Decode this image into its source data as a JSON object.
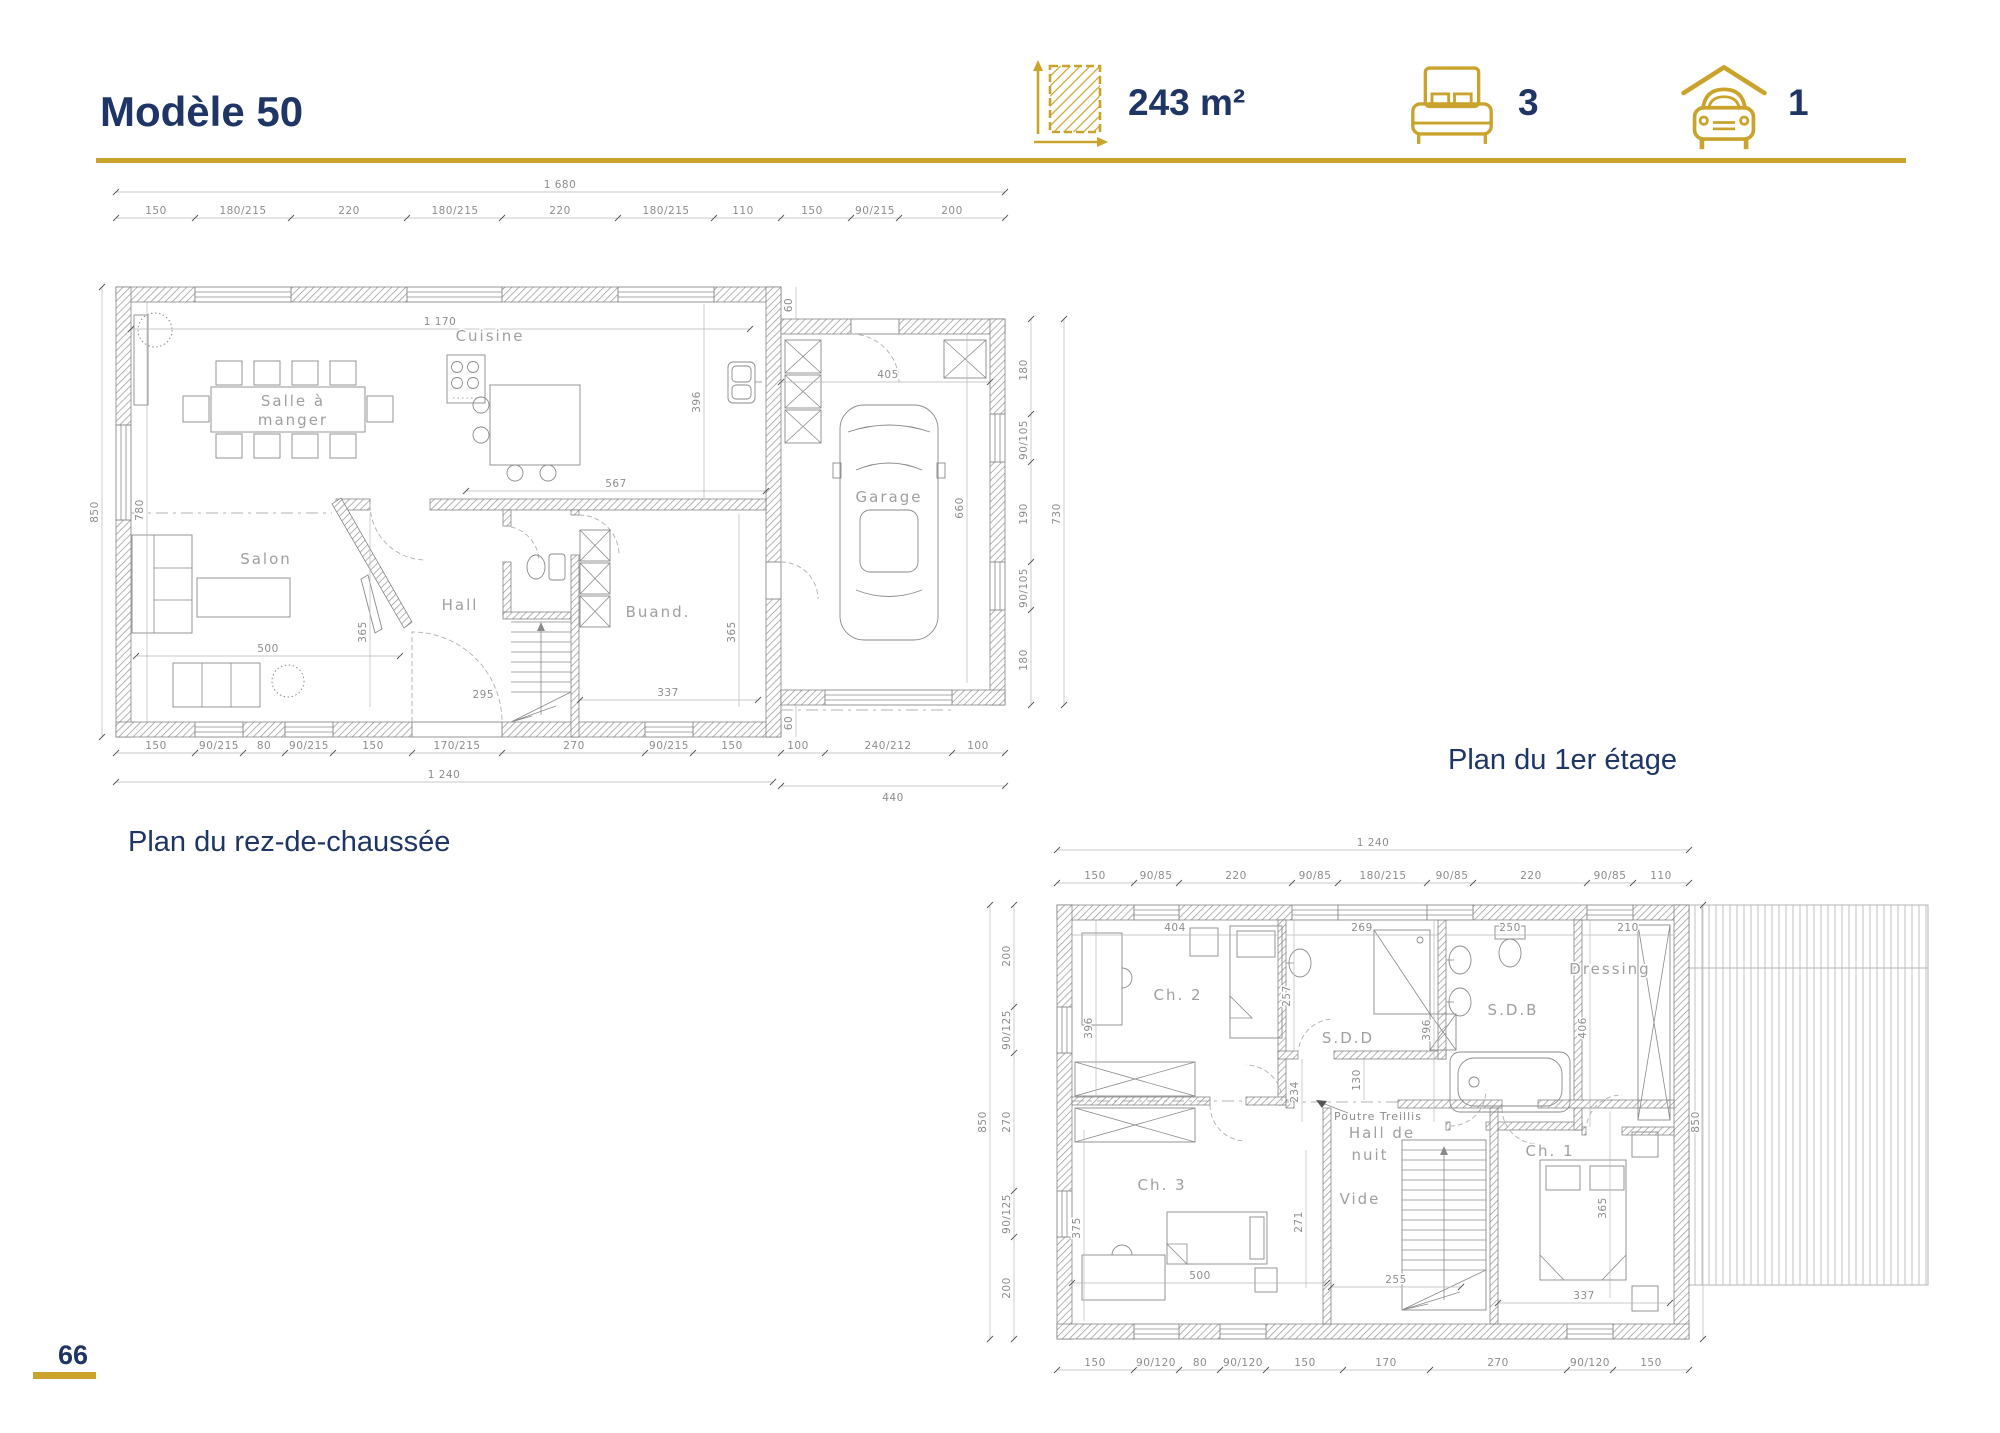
{
  "header": {
    "title": "Modèle 50",
    "area_value": "243 m²",
    "bedrooms_value": "3",
    "garage_value": "1"
  },
  "captions": {
    "ground": "Plan du rez-de-chaussée",
    "first": "Plan du 1er étage"
  },
  "footer": {
    "page_number": "66"
  },
  "ground": {
    "rooms": {
      "dining_1": "Salle à",
      "dining_2": "manger",
      "kitchen": "Cuisine",
      "living": "Salon",
      "hall": "Hall",
      "laundry": "Buand.",
      "garage": "Garage"
    },
    "dims": {
      "top_total": "1 680",
      "top_row": [
        "150",
        "180/215",
        "220",
        "180/215",
        "220",
        "180/215",
        "110",
        "150",
        "90/215",
        "200"
      ],
      "left_total": "850",
      "left_inner": "780",
      "inner_width": "1 170",
      "kitchen_depth": "396",
      "inner_567": "567",
      "hall_depth": "365",
      "stair_295": "295",
      "laundry_337": "337",
      "laundry_365": "365",
      "living_500": "500",
      "garage_405": "405",
      "garage_660": "660",
      "offset_top": "60",
      "offset_bottom": "60",
      "right_col": [
        "180",
        "90/105",
        "190",
        "90/105",
        "180"
      ],
      "right_total": "730",
      "bottom_row": [
        "150",
        "90/215",
        "80",
        "90/215",
        "150",
        "170/215",
        "270",
        "90/215",
        "150",
        "100",
        "240/212",
        "100"
      ],
      "bottom_main": "1 240",
      "bottom_garage": "440"
    }
  },
  "first": {
    "rooms": {
      "ch2": "Ch. 2",
      "sdd": "S.D.D",
      "sdb": "S.D.B",
      "dressing": "Dressing",
      "ch3": "Ch. 3",
      "hall_1": "Hall de",
      "hall_2": "nuit",
      "vide": "Vide",
      "ch1": "Ch. 1"
    },
    "annotation": "Poutre Treillis",
    "dims": {
      "top_total": "1 240",
      "top_row": [
        "150",
        "90/85",
        "220",
        "90/85",
        "180/215",
        "90/85",
        "220",
        "90/85",
        "110"
      ],
      "left_total": "850",
      "left_col": [
        "200",
        "90/125",
        "270",
        "90/125",
        "200"
      ],
      "right_total": "850",
      "bottom_row": [
        "150",
        "90/120",
        "80",
        "90/120",
        "150",
        "170",
        "270",
        "90/120",
        "150"
      ],
      "ch2_w": "404",
      "ch2_h": "396",
      "sdd_w": "269",
      "sdd_h": "257",
      "sdb_w": "250",
      "sdb_h": "396",
      "dress_w": "210",
      "dress_h": "406",
      "beam_130": "130",
      "beam_234": "234",
      "ch3_h": "375",
      "ch3_w": "500",
      "ch3_271": "271",
      "vide_255": "255",
      "ch1_h": "365",
      "ch1_w": "337"
    }
  }
}
